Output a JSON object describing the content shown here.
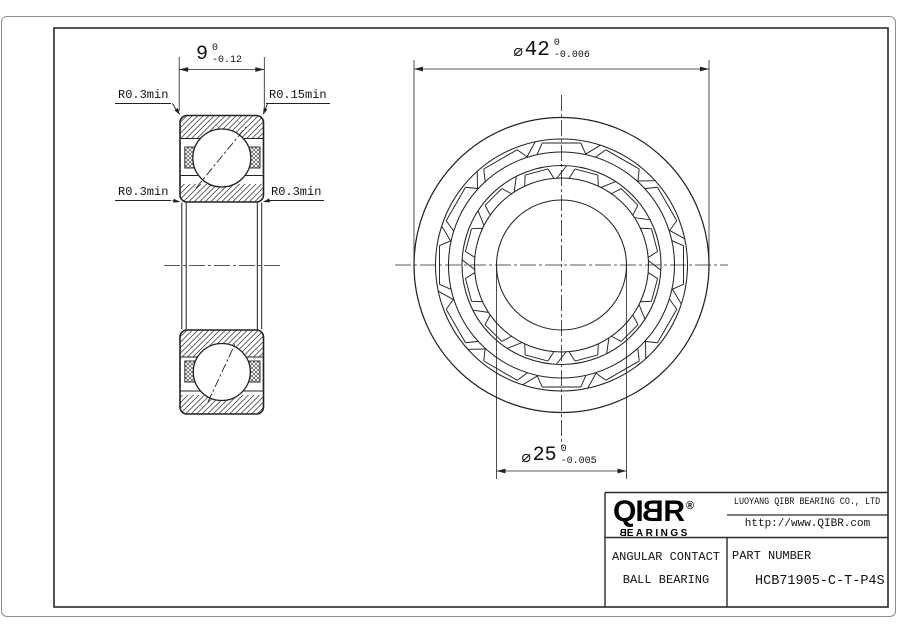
{
  "left_view": {
    "width_dim": {
      "value": "9",
      "tol_top": "0",
      "tol_bottom": "-0.12"
    },
    "labels": {
      "top_left": "R0.3min",
      "top_right": "R0.15min",
      "mid_left": "R0.3min",
      "mid_right": "R0.3min"
    }
  },
  "right_view": {
    "outer_dia_dim": {
      "prefix": "⌀",
      "value": "42",
      "tol_top": "0",
      "tol_bottom": "-0.006"
    },
    "bore_dia_dim": {
      "prefix": "⌀",
      "value": "25",
      "tol_top": "0",
      "tol_bottom": "-0.005"
    }
  },
  "title_block": {
    "logo": {
      "part1": "QI",
      "mirrored_letter": "B",
      "part2": "R",
      "registered": "®",
      "sub_mirrored_letter": "B",
      "sub_rest": "EARINGS"
    },
    "company": "LUOYANG QIBR BEARING CO., LTD",
    "website": "http://www.QIBR.com",
    "product_type_line1": "ANGULAR CONTACT",
    "product_type_line2": "BALL BEARING",
    "part_number_label": "PART NUMBER",
    "part_number": "HCB71905-C-T-P4S"
  },
  "colors": {
    "line": "#222222",
    "frame": "#2a2a2a",
    "page_border": "#8d8d8d"
  }
}
